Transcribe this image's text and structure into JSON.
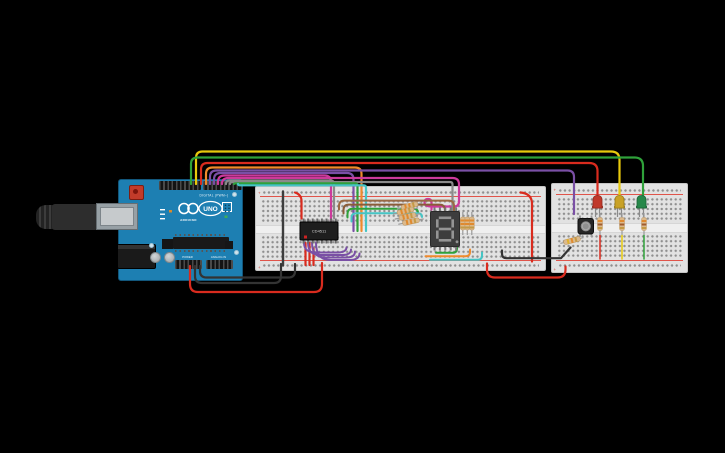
{
  "canvas": {
    "width": 725,
    "height": 453,
    "background": "#000000"
  },
  "arduino": {
    "name": "Arduino Uno R3",
    "title": "UNO",
    "brand": "ARDUINO",
    "labels": {
      "digital": "DIGITAL (PWM~)",
      "power": "POWER",
      "analog": "ANALOG IN"
    },
    "board_color": "#1d7fb2"
  },
  "breadboards": [
    {
      "id": "main",
      "size": "full",
      "columns": 60
    },
    {
      "id": "led-board",
      "size": "half",
      "columns": 30
    }
  ],
  "rails": {
    "plus": "+",
    "minus": "-"
  },
  "ic": {
    "label": "CD4511",
    "description": "BCD to 7-segment decoder driver"
  },
  "display": {
    "type": "7-segment display",
    "digit": "8",
    "lit": false
  },
  "leds": [
    {
      "color": "red",
      "hex": "#c0392b"
    },
    {
      "color": "yellow",
      "hex": "#c9a227"
    },
    {
      "color": "green",
      "hex": "#27884a"
    }
  ],
  "button": {
    "type": "pushbutton"
  },
  "resistors": {
    "display_segment": 7,
    "led": 3,
    "button": 1,
    "body_color": "#dbb98c"
  },
  "wire_colors": {
    "red": "#d92b1e",
    "yellow": "#e8c90c",
    "green": "#2fa13a",
    "orange": "#ef8a2c",
    "purple": "#7a4fa5",
    "pink": "#cc3a9b",
    "gray": "#8a8a8a",
    "brown": "#9a6a44",
    "cyan": "#45c5c5",
    "black": "#333333"
  },
  "wires": [
    {
      "color": "yellow",
      "from": "arduino digital pin",
      "to": "yellow LED"
    },
    {
      "color": "green",
      "from": "arduino digital pin",
      "to": "green LED"
    },
    {
      "color": "red",
      "from": "arduino digital pin",
      "to": "red LED"
    },
    {
      "color": "purple",
      "from": "arduino digital pin",
      "to": "pushbutton column"
    },
    {
      "color": "purple",
      "from": "arduino digital pin",
      "to": "decoder input"
    },
    {
      "color": "orange",
      "from": "arduino digital pin",
      "to": "decoder input"
    },
    {
      "color": "pink",
      "from": "arduino digital pin",
      "to": "decoder input"
    },
    {
      "color": "pink",
      "from": "arduino digital pin",
      "to": "display column"
    },
    {
      "color": "gray",
      "from": "arduino digital pin",
      "to": "decoder input"
    },
    {
      "color": "gray",
      "from": "arduino digital pin",
      "to": "display column"
    },
    {
      "color": "green",
      "from": "arduino digital pin",
      "to": "decoder column"
    },
    {
      "color": "cyan",
      "from": "arduino digital pin",
      "to": "decoder column"
    },
    {
      "color": "red",
      "from": "arduino 5V",
      "to": "main breadboard plus rail"
    },
    {
      "color": "black",
      "from": "arduino GND",
      "to": "main breadboard minus rail"
    },
    {
      "color": "black",
      "from": "arduino GND",
      "to": "main breadboard minus rail"
    },
    {
      "color": "black",
      "from": "main breadboard",
      "to": "led breadboard button row"
    },
    {
      "color": "red",
      "from": "main breadboard rail",
      "to": "led breadboard rail"
    },
    {
      "color": "red",
      "from": "top rail",
      "to": "bottom rail bridge"
    },
    {
      "color": "black",
      "from": "top rail",
      "to": "bottom rail bridge"
    },
    {
      "color": "brown",
      "from": "decoder output",
      "to": "display"
    },
    {
      "color": "brown",
      "from": "decoder output",
      "to": "display"
    },
    {
      "color": "green",
      "from": "decoder output",
      "to": "segment resistor"
    },
    {
      "color": "cyan",
      "from": "decoder output",
      "to": "segment resistor"
    },
    {
      "color": "purple",
      "from": "decoder outputs",
      "to": "display rows"
    }
  ]
}
